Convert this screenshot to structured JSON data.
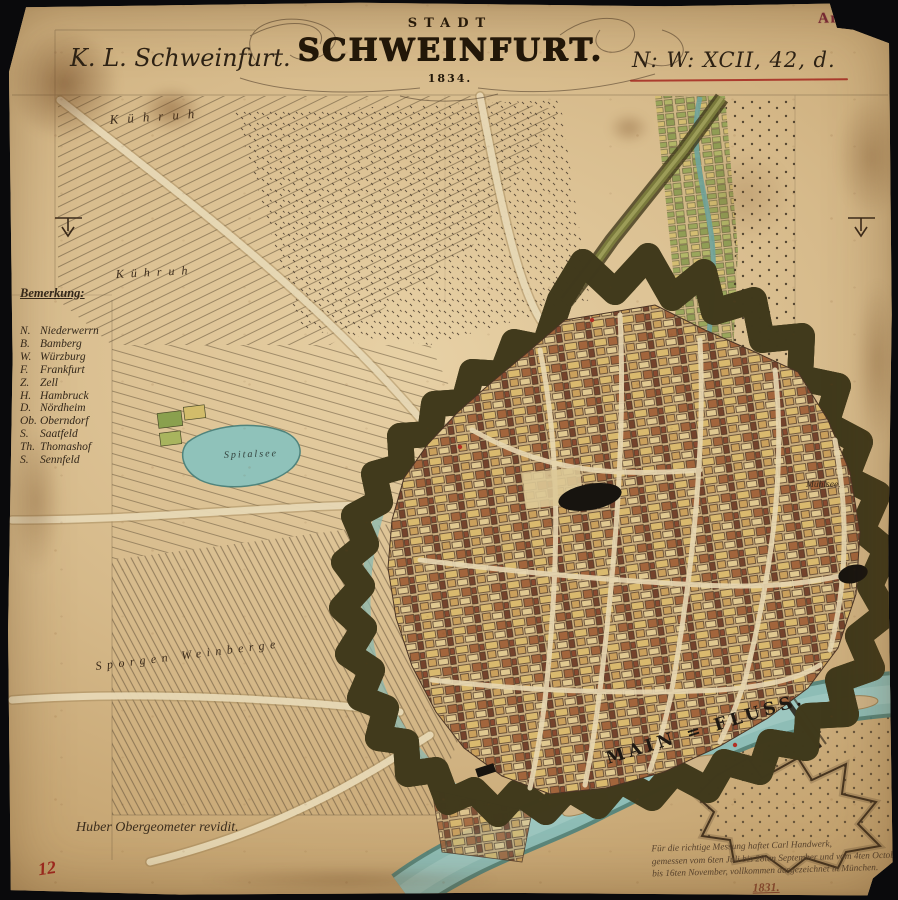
{
  "archive": {
    "stamp": "Archiv",
    "inventory_number": "12"
  },
  "header": {
    "collection": "K. L. Schweinfurt.",
    "signature": "N: W: XCII, 42, d.",
    "title_kicker": "STADT",
    "title": "SCHWEINFURT.",
    "title_year": "1834."
  },
  "legend": {
    "heading": "Bemerkung:",
    "entries": [
      {
        "abbr": "N.",
        "name": "Niederwerrn"
      },
      {
        "abbr": "B.",
        "name": "Bamberg"
      },
      {
        "abbr": "W.",
        "name": "Würzburg"
      },
      {
        "abbr": "F.",
        "name": "Frankfurt"
      },
      {
        "abbr": "Z.",
        "name": "Zell"
      },
      {
        "abbr": "H.",
        "name": "Hambruck"
      },
      {
        "abbr": "D.",
        "name": "Nördheim"
      },
      {
        "abbr": "Ob.",
        "name": "Oberndorf"
      },
      {
        "abbr": "S.",
        "name": "Saatfeld"
      },
      {
        "abbr": "Th.",
        "name": "Thomashof"
      },
      {
        "abbr": "S.",
        "name": "Sennfeld"
      }
    ]
  },
  "map_labels": {
    "river": "MAIN = FLUSS.",
    "pond": "Spitalsee",
    "mill_pond": "Mühlsee.",
    "field_upper": "Kühruh",
    "field_lower": "Kühruh",
    "vineyard": "Sporgen Weinberge"
  },
  "notes": {
    "surveyor": "Huber Obergeometer revidit.",
    "certification": [
      "Für die richtige Messung haftet Carl Handwerk,",
      "gemessen vom 6ten Juli bis 28ten September und vom 4ten October",
      "bis 16ten November, vollkommen ausgezeichnet in München."
    ],
    "certification_date": "1831."
  },
  "colors": {
    "paper": "#cfae7e",
    "ink": "#3a2a1a",
    "red_ink": "#a3271f",
    "stamp_red": "#7c2838",
    "fortification_green": "#6f7035",
    "water_teal": "#86b5ad",
    "city_yellow": "#d9b96e",
    "city_maroon": "#8a4a30"
  }
}
